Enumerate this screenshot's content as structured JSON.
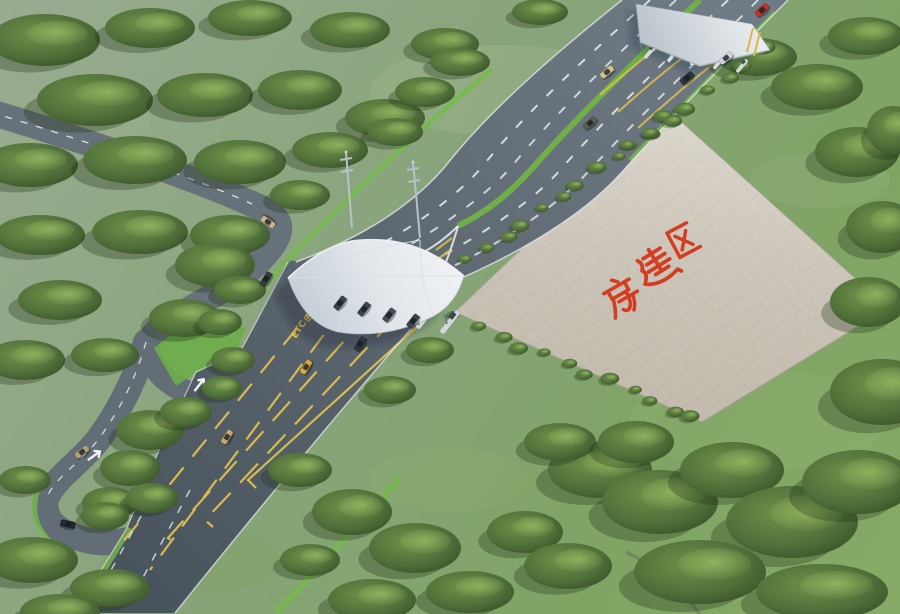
{
  "scene": {
    "description": "Aerial 3D rendering of an expressway toll station with membrane canopy, secondary toll gate, access roads, tiled construction plaza and wooded grassland",
    "plaza": {
      "label": "房建区",
      "label_color": "#d4381c"
    },
    "toll_lane": {
      "etc_label": "ETC",
      "speed_label": "20"
    },
    "colors": {
      "grass_top": "#9aab90",
      "grass_mid": "#87a47a",
      "grass_bottom": "#86ab67",
      "road": "#5d6871",
      "road_light": "#707a84",
      "road_dark": "#49545d",
      "lane_white": "#eef2f4",
      "lane_yellow": "#d9bf4e",
      "median_green": "#6fae48",
      "hedge_green": "#76b94e",
      "tree_dark": "#354d24",
      "tree_light": "#6f9149",
      "plaza_tile": "#cec7ba",
      "plaza_grid": "#b5ac9d",
      "canopy_light": "#f6f8fa",
      "canopy_shade": "#c2cbd3",
      "text_red": "#d4381c"
    },
    "counts": {
      "main_toll_islands": 6,
      "secondary_gate_islands": 5,
      "canopy_masts": 2
    },
    "cars": [
      {
        "x": 762,
        "y": 10,
        "angle": -42,
        "color": "#c03225",
        "name": "red-car"
      },
      {
        "x": 726,
        "y": 58,
        "angle": -40,
        "color": "#ced3d7",
        "name": "silver-car"
      },
      {
        "x": 687,
        "y": 78,
        "angle": -40,
        "color": "#2c343d",
        "name": "dark-car"
      },
      {
        "x": 607,
        "y": 72,
        "angle": -40,
        "color": "#d8c387",
        "name": "tan-car"
      },
      {
        "x": 590,
        "y": 123,
        "angle": -40,
        "color": "#5a604e",
        "name": "truck"
      },
      {
        "x": 268,
        "y": 222,
        "angle": -145,
        "color": "#c9b584",
        "name": "tan-car"
      },
      {
        "x": 266,
        "y": 279,
        "angle": -58,
        "color": "#343b44",
        "name": "dark-car"
      },
      {
        "x": 340,
        "y": 303,
        "angle": -52,
        "color": "#39414a",
        "name": "toll-lane-car"
      },
      {
        "x": 364,
        "y": 309,
        "angle": -52,
        "color": "#3d444d",
        "name": "toll-lane-car"
      },
      {
        "x": 389,
        "y": 315,
        "angle": -52,
        "color": "#444b54",
        "name": "toll-lane-car"
      },
      {
        "x": 413,
        "y": 321,
        "angle": -52,
        "color": "#3a424b",
        "name": "toll-lane-car"
      },
      {
        "x": 360,
        "y": 344,
        "angle": -58,
        "color": "#2f363e",
        "name": "dark-car"
      },
      {
        "x": 306,
        "y": 367,
        "angle": -58,
        "color": "#d6ac38",
        "name": "yellow-car"
      },
      {
        "x": 227,
        "y": 437,
        "angle": -58,
        "color": "#c7a96d",
        "name": "tan-car"
      },
      {
        "x": 82,
        "y": 452,
        "angle": -38,
        "color": "#b5a374",
        "name": "tan-car"
      },
      {
        "x": 68,
        "y": 524,
        "angle": 12,
        "color": "#23282e",
        "name": "police-car"
      }
    ],
    "trees": {
      "blobs": [
        [
          45,
          40,
          55,
          26
        ],
        [
          150,
          28,
          45,
          20
        ],
        [
          250,
          18,
          42,
          18
        ],
        [
          350,
          30,
          40,
          18
        ],
        [
          445,
          44,
          34,
          16
        ],
        [
          540,
          12,
          28,
          13
        ],
        [
          95,
          100,
          58,
          26
        ],
        [
          205,
          95,
          48,
          22
        ],
        [
          300,
          90,
          42,
          20
        ],
        [
          385,
          118,
          40,
          19
        ],
        [
          425,
          92,
          30,
          15
        ],
        [
          460,
          62,
          30,
          14
        ],
        [
          30,
          165,
          48,
          22
        ],
        [
          135,
          160,
          52,
          24
        ],
        [
          240,
          162,
          46,
          22
        ],
        [
          330,
          150,
          38,
          18
        ],
        [
          395,
          132,
          28,
          14
        ],
        [
          40,
          235,
          45,
          20
        ],
        [
          140,
          232,
          48,
          22
        ],
        [
          230,
          235,
          40,
          20
        ],
        [
          300,
          195,
          30,
          15
        ],
        [
          215,
          265,
          40,
          22
        ],
        [
          185,
          318,
          36,
          19
        ],
        [
          240,
          290,
          26,
          14
        ],
        [
          60,
          300,
          42,
          20
        ],
        [
          25,
          360,
          40,
          20
        ],
        [
          105,
          355,
          34,
          17
        ],
        [
          220,
          322,
          22,
          13
        ],
        [
          233,
          360,
          22,
          13
        ],
        [
          222,
          388,
          20,
          12
        ],
        [
          150,
          430,
          34,
          20
        ],
        [
          130,
          468,
          30,
          18
        ],
        [
          110,
          503,
          28,
          16
        ],
        [
          152,
          498,
          26,
          15
        ],
        [
          186,
          412,
          26,
          15
        ],
        [
          105,
          516,
          24,
          14
        ],
        [
          32,
          560,
          46,
          23
        ],
        [
          110,
          588,
          40,
          19
        ],
        [
          25,
          480,
          26,
          14
        ],
        [
          60,
          612,
          40,
          18
        ],
        [
          300,
          470,
          32,
          17
        ],
        [
          352,
          512,
          40,
          23
        ],
        [
          415,
          548,
          46,
          25
        ],
        [
          470,
          592,
          44,
          21
        ],
        [
          525,
          532,
          38,
          21
        ],
        [
          568,
          566,
          44,
          23
        ],
        [
          372,
          600,
          44,
          21
        ],
        [
          310,
          560,
          30,
          16
        ],
        [
          600,
          470,
          52,
          28
        ],
        [
          660,
          502,
          58,
          32
        ],
        [
          732,
          470,
          52,
          28
        ],
        [
          792,
          522,
          66,
          36
        ],
        [
          858,
          482,
          56,
          32
        ],
        [
          700,
          572,
          66,
          32
        ],
        [
          822,
          592,
          66,
          28
        ],
        [
          560,
          442,
          36,
          19
        ],
        [
          636,
          442,
          38,
          21
        ],
        [
          390,
          390,
          26,
          14
        ],
        [
          430,
          350,
          24,
          13
        ],
        [
          882,
          392,
          52,
          33
        ],
        [
          868,
          302,
          38,
          25
        ],
        [
          882,
          227,
          36,
          26
        ],
        [
          857,
          152,
          42,
          25
        ],
        [
          817,
          87,
          46,
          23
        ],
        [
          757,
          57,
          40,
          19
        ],
        [
          866,
          36,
          38,
          19
        ],
        [
          893,
          130,
          26,
          24
        ]
      ],
      "rows": [
        {
          "x1": 470,
          "y1": 262,
          "x2": 668,
          "y2": 118,
          "n": 12,
          "r": 8
        },
        {
          "x1": 458,
          "y1": 318,
          "x2": 695,
          "y2": 418,
          "n": 12,
          "r": 8
        },
        {
          "x1": 632,
          "y1": 148,
          "x2": 764,
          "y2": 50,
          "n": 8,
          "r": 9
        }
      ]
    }
  }
}
